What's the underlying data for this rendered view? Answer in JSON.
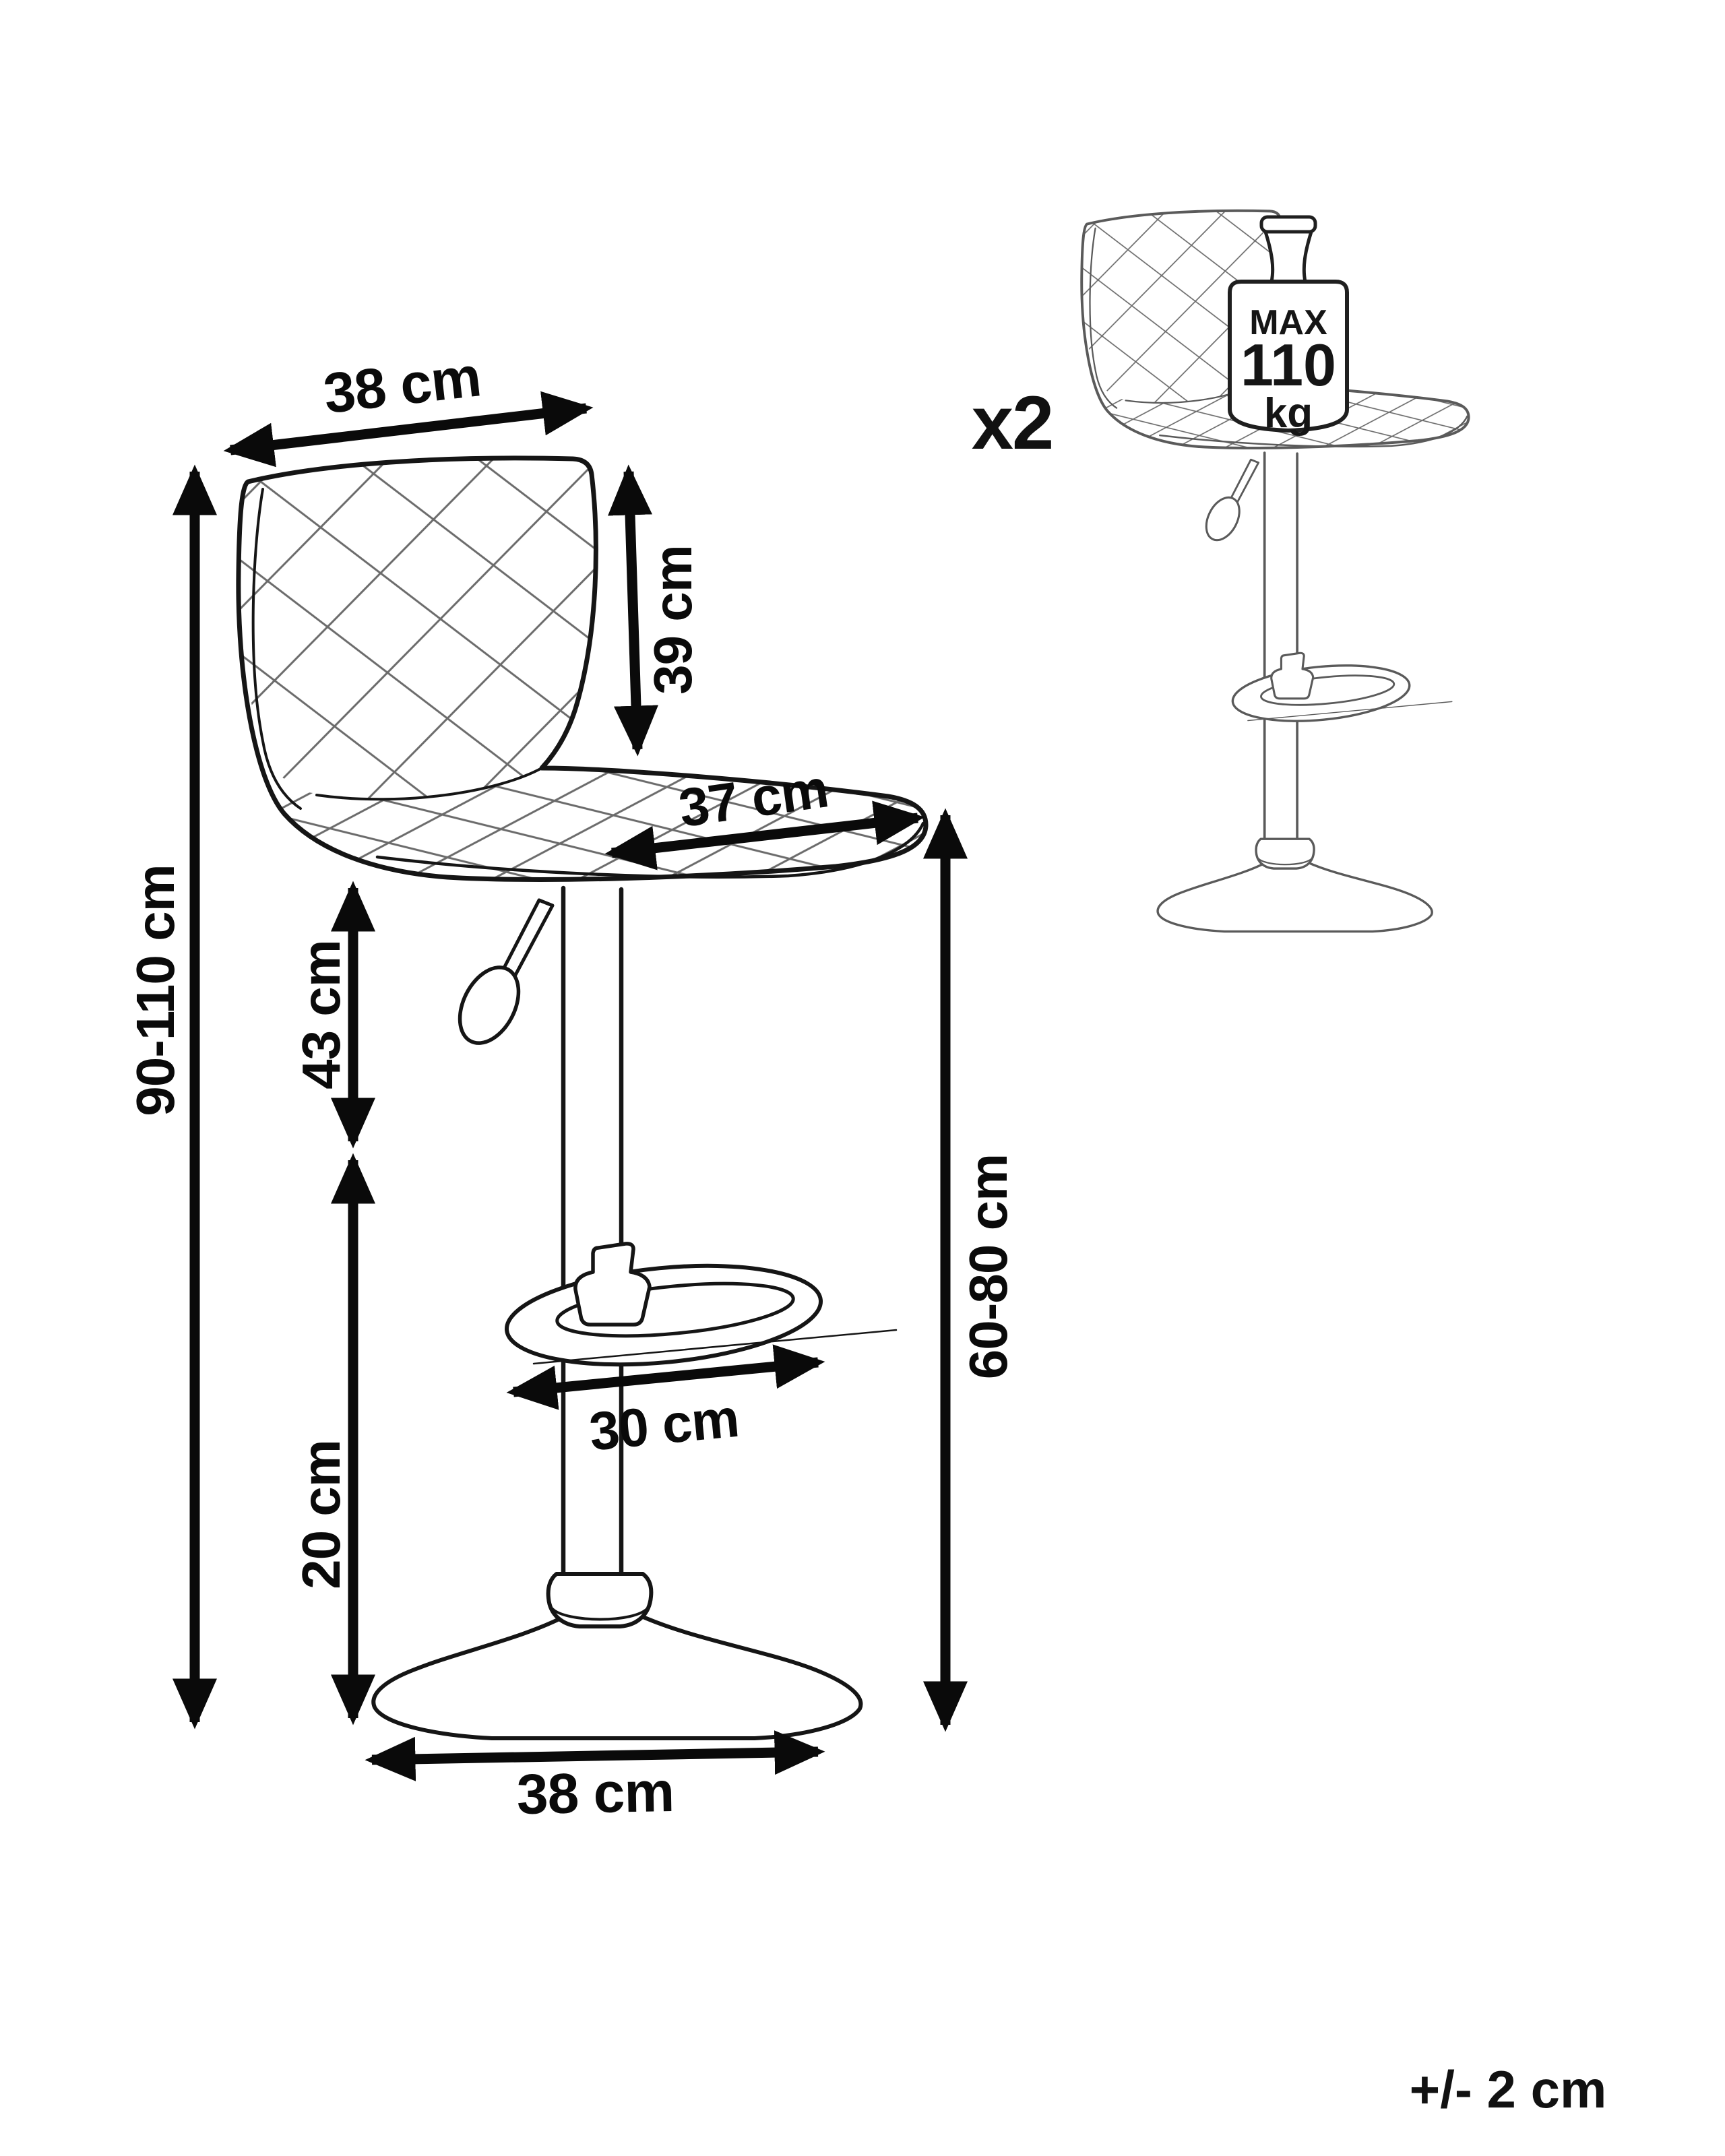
{
  "diagram": {
    "dimensions": {
      "backrest_width": "38 cm",
      "backrest_height": "39 cm",
      "seat_depth": "37 cm",
      "total_height": "90-110 cm",
      "gas_lift_column": "43 cm",
      "footrest_width": "30 cm",
      "lower_column": "20 cm",
      "seat_height": "60-80 cm",
      "base_width": "38 cm"
    },
    "badges": {
      "quantity": "x2",
      "max_weight_word": "MAX",
      "max_weight_value": "110",
      "max_weight_unit": "kg",
      "tolerance": "+/- 2 cm"
    },
    "icons": {
      "weight_icon": "calibration-weight",
      "main_drawing": "adjustable-bar-stool-side-view",
      "secondary_drawing": "adjustable-bar-stool-small"
    },
    "colors": {
      "line": "#151515",
      "dimension": "#0a0a0a",
      "small_stool_line": "#5a5a5a",
      "quilt_line": "#6b6b6b",
      "weight_outline": "#1f1f1f",
      "background": "#ffffff"
    }
  }
}
